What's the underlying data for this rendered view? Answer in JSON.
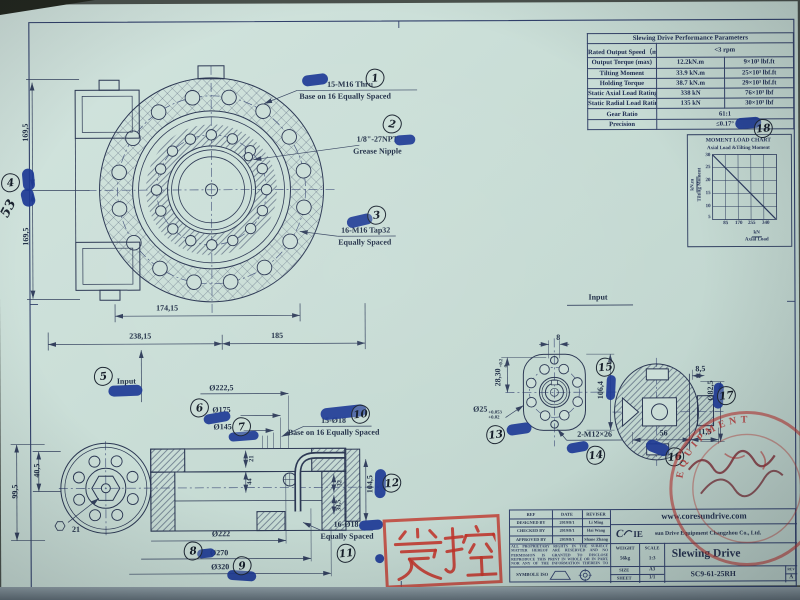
{
  "callouts": {
    "c1a": "15-M16 Thru",
    "c1b": "Base on 16  Equally Spaced",
    "c2a": "1/8\"-27NPT",
    "c2b": "Grease Nipple",
    "c3a": "16-M16 Tap32",
    "c3b": "Equally Spaced",
    "c10a": "15-Ø18",
    "c10b": "Base on 16 Equally Spaced",
    "c11a": "16-Ø18",
    "c11b": "Equally Spaced",
    "c14": "2-M12×26"
  },
  "dims": {
    "d169a": "169,5",
    "d169b": "169,5",
    "d53": "53",
    "d174": "174,15",
    "d238": "238,15",
    "d185": "185",
    "d2225": "Ø222,5",
    "d175": "Ø175",
    "d145": "Ø145",
    "d405": "40,5",
    "d995": "99,5",
    "d21hex": "21",
    "d21": "21",
    "d44": "44",
    "d32": "32",
    "d335": "33,5",
    "d1045": "104,5",
    "d222": "Ø222",
    "d270": "Ø270",
    "d320": "Ø320",
    "d8": "8",
    "d2830": "28,30",
    "t2830top": "+0.2",
    "t2830bot": "0",
    "d25": "Ø25",
    "t25top": "+0.053",
    "t25bot": "+0.02",
    "d1064": "106,4",
    "d85": "8,5",
    "d825": "Ø82,5",
    "d56": "56",
    "d115": "11,5"
  },
  "inputs": {
    "side": "Input",
    "flange": "Input"
  },
  "markers": [
    "1",
    "2",
    "3",
    "4",
    "5",
    "6",
    "7",
    "8",
    "9",
    "10",
    "11",
    "12",
    "13",
    "14",
    "15",
    "16",
    "17",
    "18"
  ],
  "table": {
    "title": "Slewing Drive Performance Parameters",
    "rows": [
      {
        "label": "Rated Output Speed（max）",
        "v1": "<3 rpm",
        "v2": ""
      },
      {
        "label": "Output Torque (max)",
        "v1": "12.2kN.m",
        "v2": "9×10³ lbf.ft"
      },
      {
        "label": "Tilting Moment",
        "v1": "33.9 kN.m",
        "v2": "25×10³ lbf.ft"
      },
      {
        "label": "Holding Torque",
        "v1": "38.7 kN.m",
        "v2": "29×10³ lbf.ft"
      },
      {
        "label": "Static Axial Load Rating",
        "v1": "338 kN",
        "v2": "76×10³ lbf"
      },
      {
        "label": "Static Radial Load Rating",
        "v1": "135 kN",
        "v2": "30×10³ lbf"
      },
      {
        "label": "Gear Ratio",
        "v1": "61:1",
        "v2": ""
      },
      {
        "label": "Precision",
        "v1": "≤0.17°",
        "v2": ""
      }
    ]
  },
  "chart_data": {
    "type": "line",
    "title": "MOMENT LOAD CHART",
    "subtitle": "Axial Load &Tilting Moment",
    "ylabel_unit": "kN.m",
    "ylabel_name": "Tilting Moment",
    "xlabel_unit": "kN",
    "xlabel_name": "Axial Load",
    "x": [
      0,
      339.8
    ],
    "series": [
      {
        "name": "axial-load-vs-tilting-moment",
        "values": [
          33.9,
          0
        ]
      }
    ],
    "xlim": [
      0,
      340
    ],
    "ylim": [
      0,
      34
    ],
    "x_ticks": [
      "85",
      "170",
      "255",
      "340"
    ],
    "y_ticks": [
      "30",
      "25",
      "20",
      "15",
      "10",
      "5"
    ],
    "grid": true,
    "legend": false
  },
  "titleblock": {
    "h_ref": "REF",
    "h_date": "DATE",
    "h_reviser": "REVISER",
    "rows": [
      {
        "role": "DESIGNED BY",
        "date": "2019/8/1",
        "name": "Li Ming"
      },
      {
        "role": "CHECKED BY",
        "date": "2019/8/1",
        "name": "Hai Wang"
      },
      {
        "role": "APPROVED BY",
        "date": "2019/8/1",
        "name": "Shane Zhang"
      }
    ],
    "legal": "ALL PROPRIETARY RIGHTS IN THE SUBJECT MATTER HEREOF ARE RESERVED AND NO PERMISSION IS GRANTED TO DISCLOSE REPRODUCE THIS PRINT IN WHOLE OR IN PART, NOR ANY OF THE INFORMATION THEREIN TO OTHERS.",
    "symbole": "SYMBOLE ISO",
    "website": "www.coresundrive.com",
    "logo_left": "C",
    "logo_right": "IE",
    "company": "sun Drive Equipment Changzhou Co., Ltd.",
    "weight_label": "WEIGHT",
    "scale_label": "SCALE",
    "weight": "56kg",
    "scale": "1:3",
    "size_label": "SIZE",
    "size": "A3",
    "sheet_label": "SHEET",
    "sheet": "1/1",
    "product": "Slewing Drive",
    "part_no": "SC9-61-25RH",
    "rev_label": "REV",
    "rev": "A"
  },
  "stamps": {
    "controlled": "受控",
    "seal_arc": "EQUIPMENT"
  }
}
